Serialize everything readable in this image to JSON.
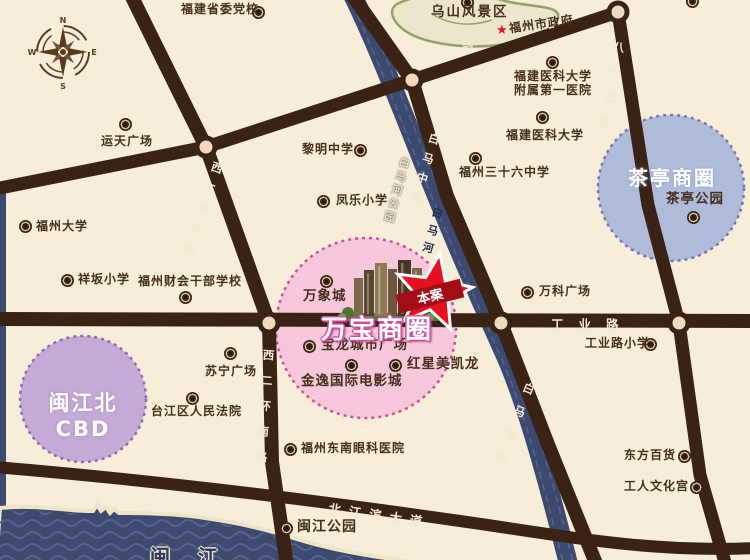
{
  "map_type": "real-estate location map (Fuzhou)",
  "compass": {
    "north": "N",
    "east": "E",
    "south": "S",
    "west": "W"
  },
  "business_circles": {
    "wanbao": {
      "name": "万宝商圈",
      "fill": "#f7c8db",
      "border": "#cf4f9c"
    },
    "chating": {
      "name": "茶亭商圈",
      "fill": "#afbcd9",
      "border": "#7d72b4"
    },
    "minjiang": {
      "name": "闽江北CBD",
      "fill": "#c5a9d6",
      "border": "#9068b4"
    }
  },
  "project": {
    "marker_label": "本案",
    "star_color": "#e8101e",
    "ribbon_color": "#a30d18"
  },
  "roads": {
    "wushan_west": "乌山西路",
    "xierhuan_middle": "西二环中路",
    "xierhuan_south": "西二环南路",
    "baima_middle": "白马中路",
    "baima_south": "白马南路",
    "bayiqi": "八一七路",
    "gongye": "工业路",
    "beijiangbin": "北江滨大道"
  },
  "rivers": {
    "baima_park": "白马河公园",
    "baima": "白马河",
    "minjiang": "闽江"
  },
  "areas": {
    "wushan_scenic": "乌山风景区"
  },
  "pois": {
    "dangxiao": "福建省委党校",
    "yuntian": "运天广场",
    "fuzhou_univ": "福州大学",
    "xiangban": "祥坂小学",
    "caikuai": "福州财会干部学校",
    "liming": "黎明中学",
    "fengle": "凤乐小学",
    "shizhengfu": "福州市政府",
    "yike_fuyi_line1": "福建医科大学",
    "yike_fuyi_line2": "附属第一医院",
    "yike_univ": "福建医科大学",
    "no36_school": "福州三十六中学",
    "chating_park": "茶亭公园",
    "wanke": "万科广场",
    "gongyelu_school": "工业路小学",
    "suning": "苏宁广场",
    "fayuan": "台江区人民法院",
    "yanke": "福州东南眼科医院",
    "minjiang_park": "闽江公园",
    "dongfang": "东方百货",
    "wenhuagong": "工人文化宫",
    "wanxiangcheng": "万象城",
    "baolong": "宝龙城市广场",
    "hongxing": "红星美凯龙",
    "jinyi": "金逸国际电影城"
  },
  "colors": {
    "background": "#f6eed8",
    "road": "#3a2315",
    "water": "#3d4a70",
    "junction_fill": "#eedbbd",
    "label_text": "#46301d",
    "scenic_outline": "#94a36e"
  }
}
